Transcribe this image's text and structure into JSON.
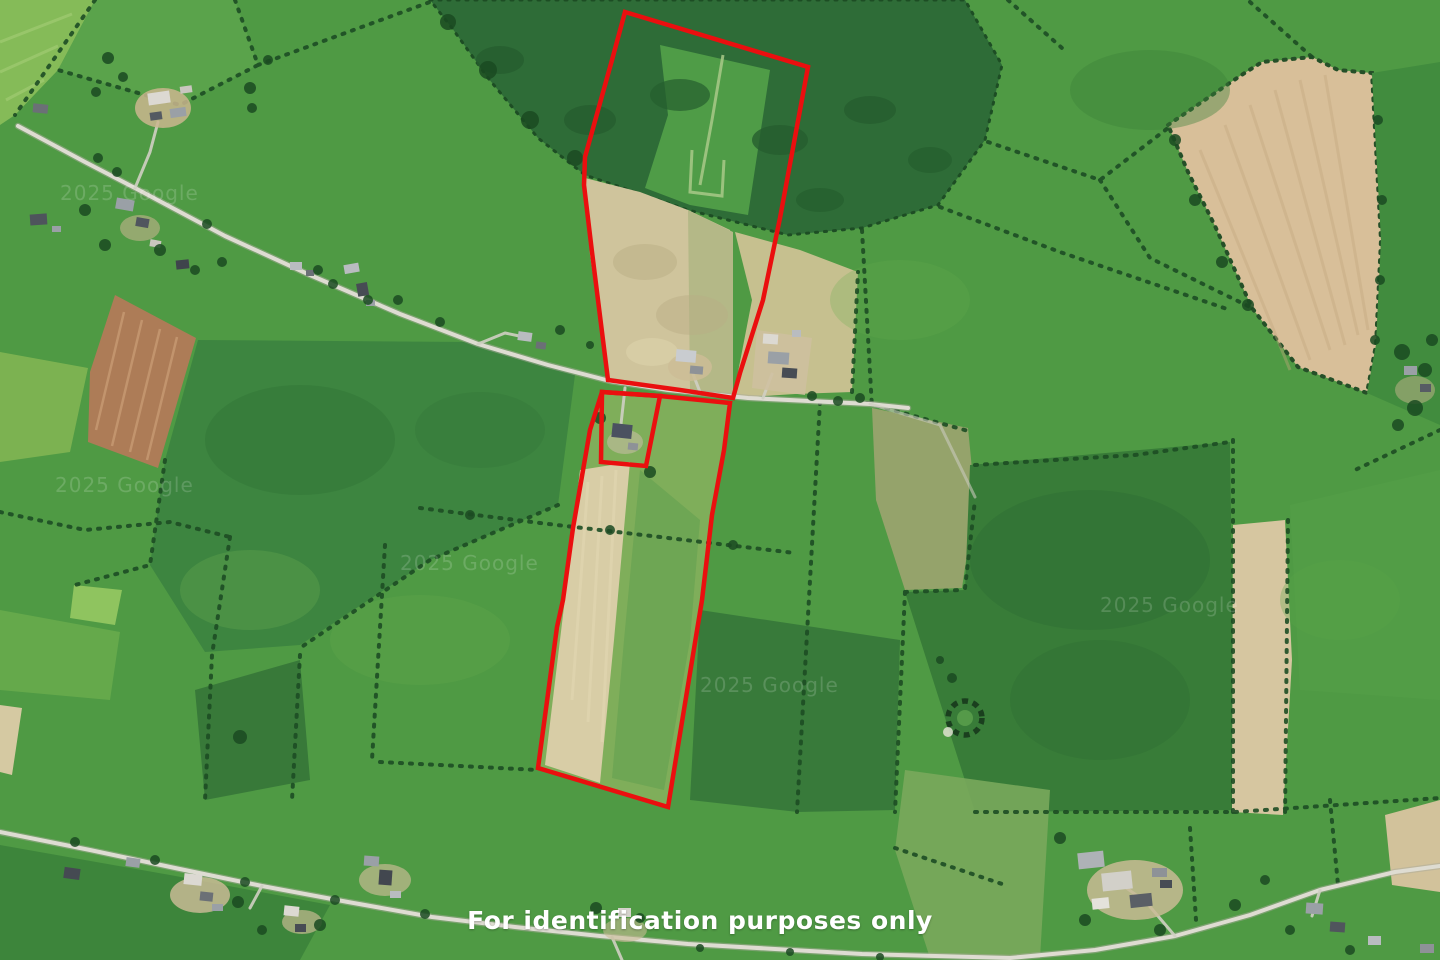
{
  "map": {
    "caption": "For identification purposes only",
    "caption_color": "#ffffff",
    "watermark_text": "2025 Google",
    "watermarks": [
      {
        "x": 60,
        "y": 200
      },
      {
        "x": 55,
        "y": 492
      },
      {
        "x": 400,
        "y": 570
      },
      {
        "x": 700,
        "y": 692
      },
      {
        "x": 1100,
        "y": 612
      }
    ],
    "boundary": {
      "color": "#ea0f0f",
      "stroke_width": 4.5,
      "parcels": [
        {
          "name": "upper-parcel-outline",
          "points": "625,12 808,67 780,218 763,300 740,373 733,398 680,390 608,380 592,252 584,185 585,157 612,60"
        },
        {
          "name": "house-plot-outline",
          "points": "602,392 660,396 646,466 601,462"
        },
        {
          "name": "lower-strip-outline",
          "points": "602,392 660,396 730,403 724,450 712,515 702,600 668,807 538,768 557,627 563,600 573,528 590,430"
        }
      ]
    }
  }
}
